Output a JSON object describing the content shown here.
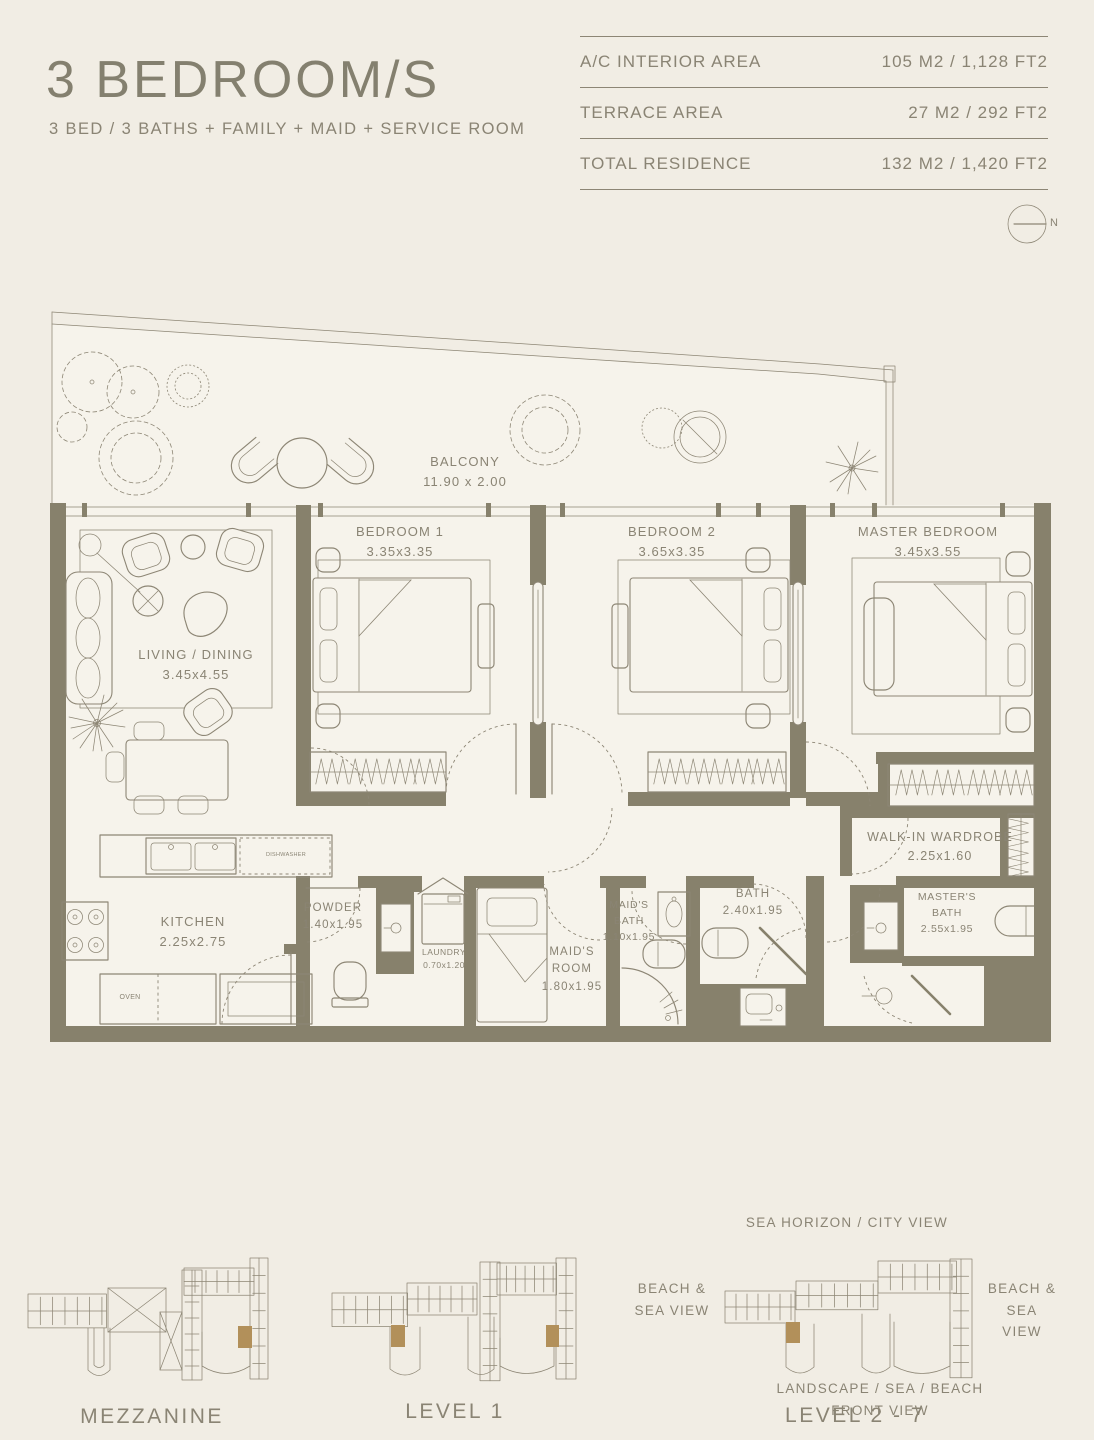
{
  "header": {
    "title": "3 BEDROOM/S",
    "subtitle": "3 BED / 3 BATHS + FAMILY + MAID + SERVICE ROOM"
  },
  "area_table": {
    "rows": [
      {
        "label": "A/C INTERIOR AREA",
        "value": "105 M2 / 1,128 FT2"
      },
      {
        "label": "TERRACE AREA",
        "value": "27 M2 / 292 FT2"
      },
      {
        "label": "TOTAL RESIDENCE",
        "value": "132 M2 / 1,420 FT2"
      }
    ]
  },
  "compass": {
    "north_label": "N"
  },
  "floor_plan": {
    "balcony": {
      "name": "BALCONY",
      "dims": "11.90 x 2.00"
    },
    "living": {
      "name": "LIVING / DINING",
      "dims": "3.45x4.55"
    },
    "bedroom1": {
      "name": "BEDROOM 1",
      "dims": "3.35x3.35"
    },
    "bedroom2": {
      "name": "BEDROOM 2",
      "dims": "3.65x3.35"
    },
    "master_bedroom": {
      "name": "MASTER BEDROOM",
      "dims": "3.45x3.55"
    },
    "kitchen": {
      "name": "KITCHEN",
      "dims": "2.25x2.75"
    },
    "powder": {
      "name": "POWDER",
      "dims": "1.40x1.95"
    },
    "laundry": {
      "name": "LAUNDRY",
      "dims": "0.70x1.20"
    },
    "maids_room": {
      "line1": "MAID'S",
      "line2": "ROOM",
      "dims": "1.80x1.95"
    },
    "maids_bath": {
      "line1": "MAID'S",
      "line2": "BATH",
      "dims": "1.10x1.95"
    },
    "bath": {
      "name": "BATH",
      "dims": "2.40x1.95"
    },
    "walk_in_wardrobe": {
      "name": "WALK-IN WARDROBE",
      "dims": "2.25x1.60"
    },
    "masters_bath": {
      "line1": "MASTER'S",
      "line2": "BATH",
      "dims": "2.55x1.95"
    },
    "appliances": {
      "dishwasher": "DISHWASHER",
      "oven": "OVEN"
    }
  },
  "levels": {
    "mezzanine": {
      "caption": "MEZZANINE"
    },
    "level1": {
      "caption": "LEVEL 1"
    },
    "level2_7": {
      "caption": "LEVEL 2 - 7",
      "view_top": "SEA HORIZON / CITY VIEW",
      "view_left_line1": "BEACH &",
      "view_left_line2": "SEA VIEW",
      "view_right_line1": "BEACH &",
      "view_right_line2": "SEA VIEW",
      "view_bottom": "LANDSCAPE / SEA / BEACH FRONT VIEW"
    }
  },
  "colors": {
    "page_background": "#f1ede4",
    "plan_floor": "#f6f3eb",
    "wall": "#87816c",
    "line": "#8d8675",
    "text": "#8a8474",
    "unit_highlight": "#b2905a"
  }
}
